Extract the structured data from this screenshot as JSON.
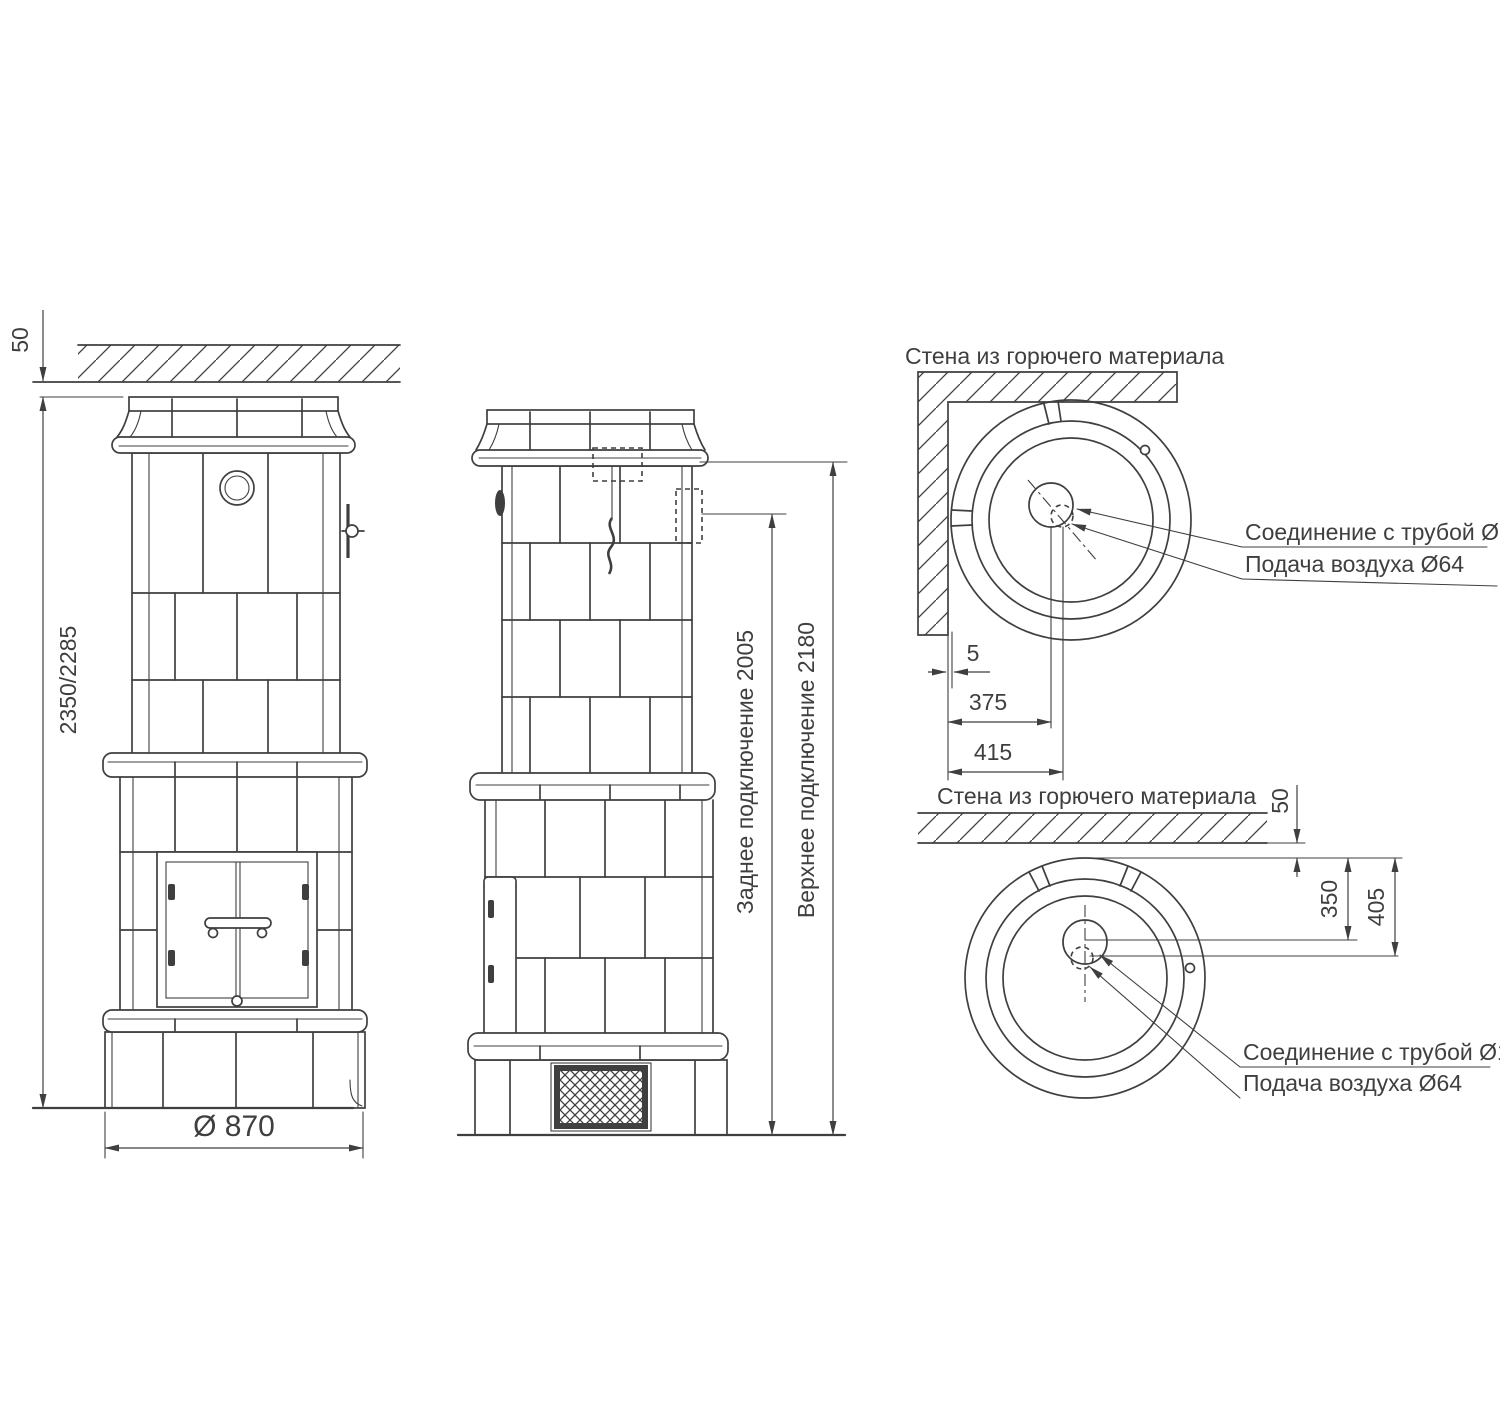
{
  "front_view": {
    "dim_ceiling_gap": "50",
    "dim_total_height": "2350/2285",
    "dim_diameter": "Ø 870"
  },
  "side_view": {
    "dim_rear_connection": "Заднее подключение 2005",
    "dim_top_connection": "Верхнее подключение 2180"
  },
  "corner_plan_view": {
    "wall_label": "Стена из горючего материала",
    "dim_wall_gap": "5",
    "dim_flue_offset": "375",
    "dim_air_offset": "415",
    "flue_label": "Соединение с трубой Ø154",
    "air_label": "Подача воздуха Ø64"
  },
  "wall_plan_view": {
    "wall_label": "Стена из горючего материала",
    "dim_wall_gap": "50",
    "dim_flue_offset": "350",
    "dim_air_offset": "405",
    "flue_label": "Соединение с трубой Ø154",
    "air_label": "Подача воздуха Ø64"
  },
  "colors": {
    "line": "#3f3f3f",
    "background": "#ffffff"
  }
}
